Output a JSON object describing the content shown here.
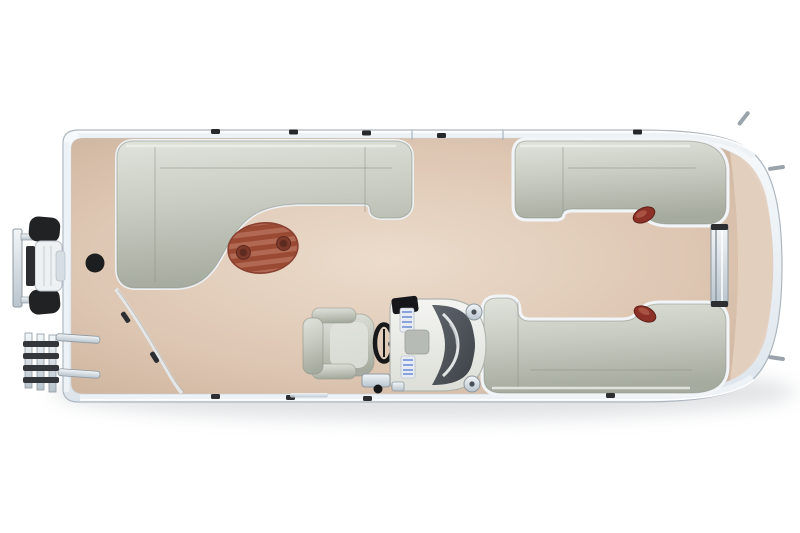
{
  "scene": {
    "title": "Pontoon boat floor plan - overhead 3D render",
    "view": "top-down"
  },
  "parts": {
    "hull": "Pontoon hull with rub rail",
    "bowDeck": "Bow deck",
    "trollingMotor": "Bow-mounted trolling motor",
    "boardingLadder": "Bow boarding ladder",
    "tableMount": "Table pedestal mount",
    "bowLounge": "Bow L-shaped lounge seating",
    "cocktailTable": "Oval woodgrain cocktail table with two cup holders",
    "bowFence": "Bow gate fence",
    "sideGate": "Port side gate opening",
    "captainsChair": "Captain's helm chair",
    "steeringWheel": "Steering wheel",
    "helmConsole": "Helm console with windshield and gauges",
    "footrest": "Helm footrest hardware",
    "sternLoungeTop": "Starboard stern wraparound lounge",
    "sternLoungeBottom": "Port stern wraparound lounge",
    "accentPadTop": "Red accent pad (starboard stern seat end)",
    "accentPadBottom": "Red accent pad (port stern seat end)",
    "sternGate": "Stern gate to rear platform",
    "sternPlatform": "Rear swim platform",
    "cleats": "Deck cleats and rail fittings",
    "railSeams": "Side gate rail seams"
  },
  "colors": {
    "background": "#ffffff",
    "hullOutline": "#aeb7c0",
    "hullRimHi": "#f7fafc",
    "hullRimLo": "#dde5ec",
    "deckLight": "#ecdccc",
    "deckMid": "#ddc6b2",
    "deckDark": "#c7ad97",
    "platform": "#e4d0bf",
    "couchHi": "#e0e3dc",
    "couchBase": "#c8ccc2",
    "couchShadow": "#a6ab9f",
    "couchEdge": "#8d9287",
    "couchWall": "#f2f5f7",
    "tableStripeA": "#b16953",
    "tableStripeB": "#9a4a33",
    "tableEdge": "#8a4030",
    "cupholder": "#7d3a2b",
    "cupholderDark": "#5f2a1f",
    "accentRed": "#8c3127",
    "accentRedDark": "#5f1f18",
    "consoleHi": "#f4f5f2",
    "consoleLo": "#dcded7",
    "consoleEdge": "#b0b5ae",
    "windHi": "#595f67",
    "windLo": "#363b41",
    "gaugeBlue": "#6f8fd8",
    "gaugePanel": "#e8ecf2",
    "chromeHi": "#f2f6f9",
    "chromeLo": "#b9c4cd",
    "chromeEdge": "#8f99a1",
    "hardwareBlack": "#202224",
    "fittingDark": "#2c2e31",
    "fenceLine": "#e3e7ea",
    "wheelBlack": "#17181a"
  }
}
